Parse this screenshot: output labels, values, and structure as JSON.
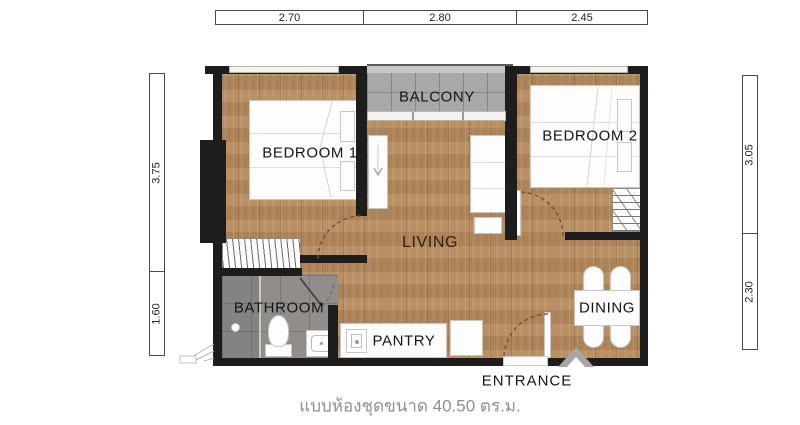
{
  "plan": {
    "caption": "แบบห้องชุดขนาด 40.50 ตร.ม.",
    "area_sqm": "40.50",
    "rooms": {
      "bedroom1": "BEDROOM 1",
      "bedroom2": "BEDROOM 2",
      "balcony": "BALCONY",
      "living": "LIVING",
      "bathroom": "BATHROOM",
      "pantry": "PANTRY",
      "dining": "DINING",
      "entrance": "ENTRANCE"
    },
    "dimensions": {
      "top": [
        "2.70",
        "2.80",
        "2.45"
      ],
      "left": [
        "3.75",
        "1.60"
      ],
      "right": [
        "3.05",
        "2.30"
      ]
    },
    "colors": {
      "wall": "#1d1d1d",
      "wood_floor": "#b5895c",
      "balcony_tile": "#a8a8a8",
      "bathroom_tile": "#908d8b",
      "furniture_outline": "#c6c6c6",
      "room_label": "#151515",
      "living_label": "#2f1d0e",
      "caption_text": "#8f8f8f",
      "entrance_arrow": "#a6a6a6"
    }
  }
}
